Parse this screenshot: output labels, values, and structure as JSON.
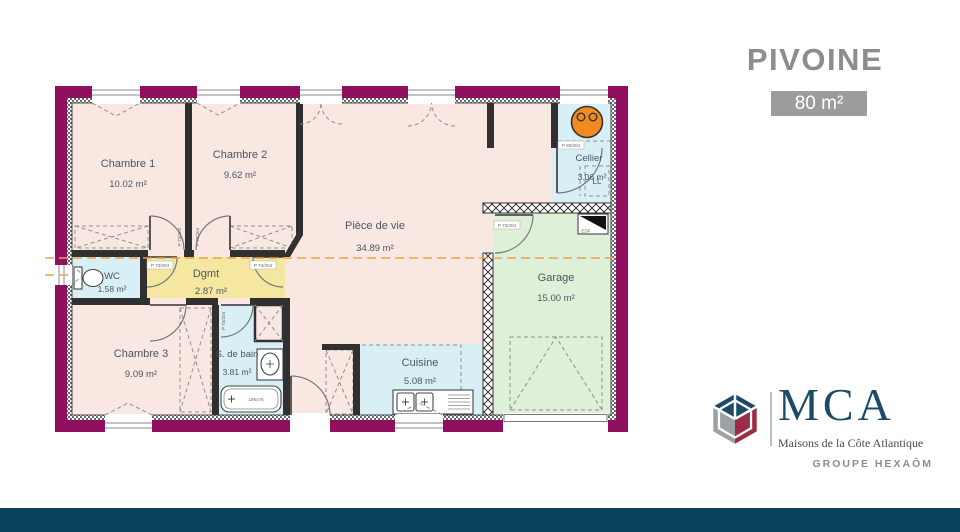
{
  "header": {
    "title": "PIVOINE",
    "area_badge": "80 m²"
  },
  "floorplan": {
    "rooms": [
      {
        "name": "Chambre 1",
        "area": "10.02 m²"
      },
      {
        "name": "Chambre 2",
        "area": "9.62 m²"
      },
      {
        "name": "Pièce de vie",
        "area": "34.89 m²"
      },
      {
        "name": "Cellier",
        "area": "3.06 m²"
      },
      {
        "name": "Garage",
        "area": "15.00 m²"
      },
      {
        "name": "WC",
        "area": "1.58 m²"
      },
      {
        "name": "Dgmt",
        "area": "2.87 m²"
      },
      {
        "name": "Chambre 3",
        "area": "9.09 m²"
      },
      {
        "name": "S. de bain",
        "area": "3.81 m²"
      },
      {
        "name": "Cuisine",
        "area": "5.08 m²"
      }
    ],
    "tags": {
      "door": "P 73/204",
      "door_cellier": "P 83/204",
      "washing_machine": "LL",
      "electrical_panel": "EDF",
      "bathtub_size": "190x75"
    }
  },
  "footer": {
    "brand_name": "MCA",
    "brand_tagline": "Maisons de la Côte Atlantique",
    "brand_group": "GROUPE HEXAÔM"
  },
  "colors": {
    "wall": "#90105F",
    "bedroom": "#F9E8E2",
    "wet_room": "#D8F0F5",
    "hallway": "#F5E7A0",
    "garage": "#DEF0D8",
    "heater": "#F28B1F",
    "section_line": "#F0A04B",
    "accent_bar": "#06435A",
    "badge_bg": "#9C9C9C",
    "title_gray": "#8D8D8D",
    "brand_blue": "#1B4B66",
    "brand_red": "#9C2C45",
    "brand_gray": "#9DA1A5"
  }
}
